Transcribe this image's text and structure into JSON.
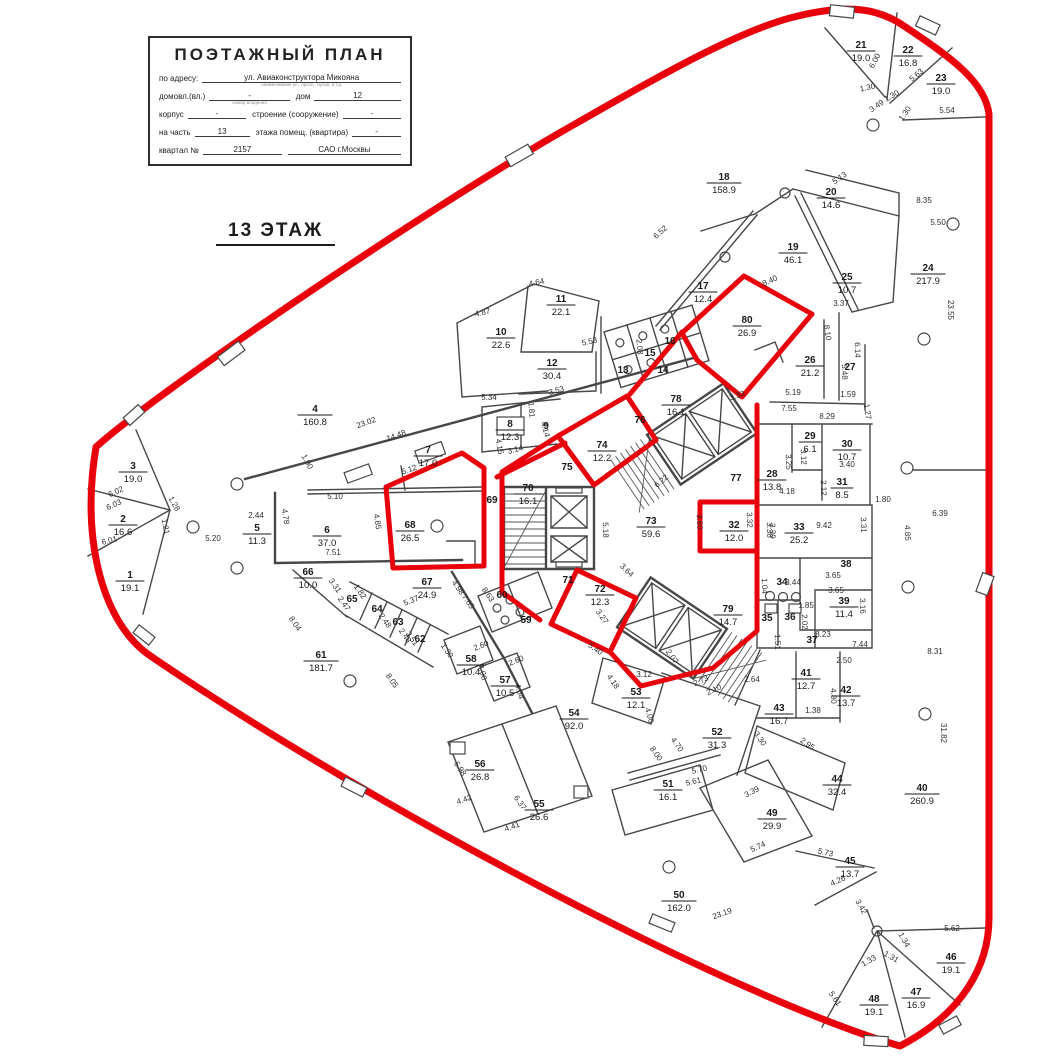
{
  "title_block": {
    "title": "ПОЭТАЖНЫЙ ПЛАН",
    "fields": [
      {
        "label": "по адресу:",
        "value": "ул. Авиаконструктора Микояна",
        "note": "наименование ул., просп., бульв. и т.д.",
        "label2": "",
        "value2": ""
      },
      {
        "label": "домовл.(вл.)",
        "value": "-",
        "note": "номер владения",
        "label2": "дом",
        "value2": "12"
      },
      {
        "label": "корпус",
        "value": "-",
        "note": "",
        "label2": "строение (сооружение)",
        "value2": "-"
      },
      {
        "label": "на часть",
        "value": "13",
        "note": "",
        "label2": "этажа помещ. (квартира)",
        "value2": "-"
      },
      {
        "label": "квартал №",
        "value": "2157",
        "note": "",
        "label2": "",
        "value2": "САО г.Москвы"
      }
    ]
  },
  "floor_label": "13 ЭТАЖ",
  "colors": {
    "boundary": "#e8000a",
    "walls": "#474747",
    "text": "#1a1a1a"
  },
  "plan": {
    "rooms": [
      [
        "1",
        "19.1",
        130,
        578
      ],
      [
        "2",
        "16.6",
        123,
        522
      ],
      [
        "3",
        "19.0",
        133,
        469
      ],
      [
        "4",
        "160.8",
        315,
        412
      ],
      [
        "5",
        "11.3",
        257,
        531
      ],
      [
        "6",
        "37.0",
        327,
        533
      ],
      [
        "7",
        "17.0",
        428,
        453
      ],
      [
        "8",
        "12.3",
        510,
        427
      ],
      [
        "9",
        null,
        546,
        429
      ],
      [
        "10",
        "22.6",
        501,
        335
      ],
      [
        "11",
        "22.1",
        561,
        302
      ],
      [
        "12",
        "30.4",
        552,
        366
      ],
      [
        "13",
        null,
        623,
        373
      ],
      [
        "14",
        null,
        663,
        373
      ],
      [
        "15",
        null,
        650,
        356
      ],
      [
        "16",
        null,
        670,
        344
      ],
      [
        "17",
        "12.4",
        703,
        289
      ],
      [
        "18",
        "158.9",
        724,
        180
      ],
      [
        "19",
        "46.1",
        793,
        250
      ],
      [
        "20",
        "14.6",
        831,
        195
      ],
      [
        "21",
        "19.0",
        861,
        48
      ],
      [
        "22",
        "16.8",
        908,
        53
      ],
      [
        "23",
        "19.0",
        941,
        81
      ],
      [
        "24",
        "217.9",
        928,
        271
      ],
      [
        "25",
        "10.7",
        847,
        280
      ],
      [
        "26",
        "21.2",
        810,
        363
      ],
      [
        "27",
        null,
        850,
        370
      ],
      [
        "28",
        "13.8",
        772,
        477
      ],
      [
        "29",
        "6.1",
        810,
        439
      ],
      [
        "30",
        "10.7",
        847,
        447
      ],
      [
        "31",
        "8.5",
        842,
        485
      ],
      [
        "32",
        "12.0",
        734,
        528
      ],
      [
        "33",
        "25.2",
        799,
        530
      ],
      [
        "34",
        null,
        782,
        585
      ],
      [
        "35",
        null,
        767,
        621
      ],
      [
        "36",
        null,
        790,
        620
      ],
      [
        "37",
        null,
        812,
        643
      ],
      [
        "38",
        null,
        846,
        567
      ],
      [
        "39",
        "11.4",
        844,
        604
      ],
      [
        "40",
        "260.9",
        922,
        791
      ],
      [
        "41",
        "12.7",
        806,
        676
      ],
      [
        "42",
        "13.7",
        846,
        693
      ],
      [
        "43",
        "16.7",
        779,
        711
      ],
      [
        "44",
        "32.4",
        837,
        782
      ],
      [
        "45",
        "13.7",
        850,
        864
      ],
      [
        "46",
        "19.1",
        951,
        960
      ],
      [
        "47",
        "16.9",
        916,
        995
      ],
      [
        "48",
        "19.1",
        874,
        1002
      ],
      [
        "49",
        "29.9",
        772,
        816
      ],
      [
        "50",
        "162.0",
        679,
        898
      ],
      [
        "51",
        "16.1",
        668,
        787
      ],
      [
        "52",
        "31.3",
        717,
        735
      ],
      [
        "53",
        "12.1",
        636,
        695
      ],
      [
        "54",
        "92.0",
        574,
        716
      ],
      [
        "55",
        "26.6",
        539,
        807
      ],
      [
        "56",
        "26.8",
        480,
        767
      ],
      [
        "57",
        "10.5",
        505,
        683
      ],
      [
        "58",
        "10.4",
        471,
        662
      ],
      [
        "59",
        null,
        526,
        623
      ],
      [
        "60",
        null,
        502,
        598
      ],
      [
        "61",
        "181.7",
        321,
        658
      ],
      [
        "62",
        null,
        420,
        642
      ],
      [
        "63",
        null,
        398,
        625
      ],
      [
        "64",
        null,
        377,
        612
      ],
      [
        "65",
        null,
        352,
        602
      ],
      [
        "66",
        "10.0",
        308,
        575
      ],
      [
        "67",
        "24.9",
        427,
        585
      ],
      [
        "68",
        "26.5",
        410,
        528
      ],
      [
        "69",
        null,
        492,
        503
      ],
      [
        "70",
        "16.1",
        528,
        491
      ],
      [
        "71",
        null,
        568,
        583
      ],
      [
        "72",
        "12.3",
        600,
        592
      ],
      [
        "73",
        "59.6",
        651,
        524
      ],
      [
        "74",
        "12.2",
        602,
        448
      ],
      [
        "75",
        null,
        567,
        470
      ],
      [
        "76",
        null,
        640,
        423
      ],
      [
        "77",
        null,
        736,
        481
      ],
      [
        "78",
        "16.1",
        676,
        402
      ],
      [
        "79",
        "14.7",
        728,
        612
      ],
      [
        "80",
        "26.9",
        747,
        323
      ]
    ],
    "dims": [
      [
        "6.00",
        877,
        62,
        -62
      ],
      [
        "5.63",
        918,
        77,
        -40
      ],
      [
        "1.30",
        868,
        90,
        -12
      ],
      [
        "1.30",
        893,
        98,
        -30
      ],
      [
        "3.49",
        878,
        108,
        -35
      ],
      [
        "1.30",
        907,
        115,
        -55
      ],
      [
        "5.54",
        947,
        113,
        0
      ],
      [
        "5.13",
        841,
        180,
        -35
      ],
      [
        "8.35",
        924,
        203,
        0
      ],
      [
        "5.50",
        938,
        225,
        0
      ],
      [
        "23.55",
        948,
        310,
        90
      ],
      [
        "6.52",
        662,
        234,
        -42
      ],
      [
        "8.40",
        771,
        283,
        -25
      ],
      [
        "3.37",
        841,
        306,
        0
      ],
      [
        "8.10",
        825,
        333,
        82
      ],
      [
        "6.14",
        855,
        350,
        88
      ],
      [
        "5.48",
        842,
        372,
        88
      ],
      [
        "5.19",
        793,
        395,
        0
      ],
      [
        "1.59",
        848,
        397,
        0
      ],
      [
        "3.33",
        738,
        398,
        -20
      ],
      [
        "1.27",
        865,
        412,
        82
      ],
      [
        "7.55",
        789,
        411,
        0
      ],
      [
        "8.29",
        827,
        419,
        0
      ],
      [
        "4.64",
        537,
        285,
        -12
      ],
      [
        "4.87",
        483,
        315,
        -12
      ],
      [
        "5.53",
        590,
        344,
        -12
      ],
      [
        "2.08",
        637,
        347,
        85
      ],
      [
        "5.34",
        489,
        400,
        0
      ],
      [
        "1.81",
        529,
        410,
        85
      ],
      [
        "3.53",
        557,
        393,
        -15
      ],
      [
        "4.14",
        543,
        430,
        75
      ],
      [
        "3.14",
        516,
        452,
        -15
      ],
      [
        "4.15",
        497,
        447,
        80
      ],
      [
        "23.02",
        367,
        425,
        -20
      ],
      [
        "14.48",
        397,
        438,
        -20
      ],
      [
        "1.90",
        305,
        463,
        60
      ],
      [
        "5.10",
        335,
        499,
        0
      ],
      [
        "5.12",
        410,
        472,
        -20
      ],
      [
        "4.78",
        283,
        517,
        82
      ],
      [
        "2.44",
        256,
        518,
        0
      ],
      [
        "4.85",
        375,
        522,
        82
      ],
      [
        "7.51",
        333,
        555,
        0
      ],
      [
        "6.02",
        117,
        494,
        -25
      ],
      [
        "6.03",
        115,
        507,
        -25
      ],
      [
        "1.21",
        163,
        527,
        80
      ],
      [
        "6.01",
        110,
        543,
        -15
      ],
      [
        "5.20",
        213,
        541,
        0
      ],
      [
        "1.28",
        172,
        505,
        60
      ],
      [
        "8.04",
        293,
        625,
        55
      ],
      [
        "8.05",
        390,
        682,
        55
      ],
      [
        "3.31",
        333,
        587,
        55
      ],
      [
        "2.47",
        342,
        605,
        55
      ],
      [
        "1.82",
        358,
        593,
        55
      ],
      [
        "2.48",
        383,
        622,
        55
      ],
      [
        "2.48",
        403,
        637,
        55
      ],
      [
        "2.51",
        410,
        640,
        55
      ],
      [
        "5.37",
        412,
        603,
        -22
      ],
      [
        "4.98",
        456,
        589,
        55
      ],
      [
        "7.65",
        466,
        603,
        55
      ],
      [
        "8.63",
        486,
        596,
        55
      ],
      [
        "1.30",
        445,
        652,
        55
      ],
      [
        "2.60",
        482,
        648,
        -22
      ],
      [
        "4.00",
        480,
        673,
        75
      ],
      [
        "2.60",
        517,
        663,
        -22
      ],
      [
        "4.04",
        517,
        692,
        75
      ],
      [
        "6.98",
        458,
        770,
        55
      ],
      [
        "4.42",
        465,
        802,
        -20
      ],
      [
        "6.37",
        518,
        804,
        55
      ],
      [
        "4.41",
        513,
        829,
        -20
      ],
      [
        "5.40",
        594,
        651,
        35
      ],
      [
        "2.07",
        670,
        658,
        55
      ],
      [
        "4.18",
        611,
        683,
        55
      ],
      [
        "3.12",
        644,
        677,
        0
      ],
      [
        "4.00",
        647,
        716,
        75
      ],
      [
        "2.73",
        702,
        683,
        -25
      ],
      [
        "2.10",
        715,
        692,
        -25
      ],
      [
        "2.64",
        752,
        682,
        0
      ],
      [
        "4.70",
        675,
        746,
        55
      ],
      [
        "8.00",
        654,
        755,
        55
      ],
      [
        "3.30",
        758,
        740,
        55
      ],
      [
        "5.70",
        700,
        772,
        -14
      ],
      [
        "5.61",
        694,
        784,
        -14
      ],
      [
        "3.39",
        753,
        794,
        -28
      ],
      [
        "5.74",
        759,
        849,
        -25
      ],
      [
        "23.19",
        723,
        916,
        -20
      ],
      [
        "3.42",
        859,
        908,
        60
      ],
      [
        "4.26",
        839,
        883,
        -25
      ],
      [
        "5.73",
        825,
        855,
        12
      ],
      [
        "5.62",
        952,
        931,
        0
      ],
      [
        "1.34",
        902,
        941,
        60
      ],
      [
        "1.31",
        890,
        959,
        30
      ],
      [
        "1.33",
        870,
        963,
        -30
      ],
      [
        "5.61",
        833,
        1000,
        55
      ],
      [
        "8.31",
        935,
        654,
        0
      ],
      [
        "31.82",
        941,
        733,
        90
      ],
      [
        "6.39",
        940,
        516,
        0
      ],
      [
        "4.85",
        905,
        533,
        88
      ],
      [
        "9.42",
        824,
        528,
        0
      ],
      [
        "3.31",
        861,
        525,
        88
      ],
      [
        "3.39",
        770,
        531,
        88
      ],
      [
        "1.80",
        883,
        502,
        0
      ],
      [
        "3.40",
        847,
        467,
        0
      ],
      [
        "3.12",
        801,
        457,
        88
      ],
      [
        "3.25",
        786,
        462,
        88
      ],
      [
        "2.12",
        821,
        488,
        88
      ],
      [
        "4.18",
        787,
        494,
        0
      ],
      [
        "3.65",
        833,
        578,
        0
      ],
      [
        "3.65",
        836,
        593,
        0
      ],
      [
        "3.44",
        793,
        585,
        0
      ],
      [
        "1.04",
        762,
        586,
        88
      ],
      [
        "3.16",
        860,
        606,
        88
      ],
      [
        "1.85",
        806,
        608,
        0
      ],
      [
        "2.02",
        802,
        622,
        88
      ],
      [
        "8.23",
        823,
        637,
        0
      ],
      [
        "1.51",
        775,
        642,
        88
      ],
      [
        "7.44",
        860,
        647,
        0
      ],
      [
        "2.50",
        844,
        663,
        0
      ],
      [
        "4.80",
        831,
        696,
        88
      ],
      [
        "1.38",
        813,
        713,
        0
      ],
      [
        "2.95",
        806,
        746,
        35
      ],
      [
        "5.18",
        603,
        530,
        88
      ],
      [
        "6.22",
        663,
        483,
        -40
      ],
      [
        "3.64",
        625,
        572,
        45
      ],
      [
        "3.27",
        600,
        618,
        55
      ],
      [
        "3.60",
        697,
        522,
        88
      ],
      [
        "3.32",
        747,
        520,
        88
      ],
      [
        "3.38",
        767,
        530,
        88
      ]
    ]
  }
}
